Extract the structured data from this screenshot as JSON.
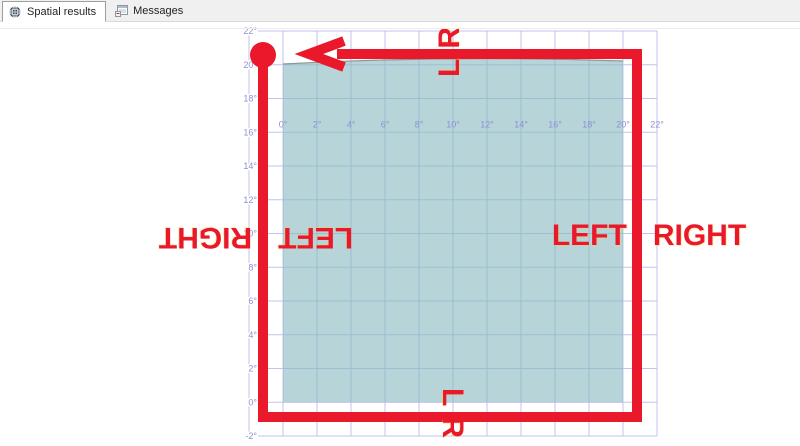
{
  "tabs": {
    "items": [
      {
        "label": "Spatial results",
        "icon": "globe-icon",
        "active": true
      },
      {
        "label": "Messages",
        "icon": "messages-icon",
        "active": false
      }
    ]
  },
  "spatial_view": {
    "grid": {
      "left": 249,
      "top": 31,
      "col_width": 34,
      "row_height": 33.75,
      "cols": 12,
      "rows": 12,
      "line_color": "#c2c2ec",
      "label_color": "#8f8fd2",
      "label_font_px": 9
    },
    "x_axis_labels": [
      "0°",
      "2°",
      "4°",
      "6°",
      "8°",
      "10°",
      "12°",
      "14°",
      "16°",
      "18°",
      "20°",
      "22°"
    ],
    "x_axis_label_row_y": 127.5,
    "y_axis_labels": [
      "22°",
      "20°",
      "18°",
      "16°",
      "14°",
      "12°",
      "10°",
      "8°",
      "6°",
      "4°",
      "2°",
      "0°",
      "-2°"
    ],
    "polygon": {
      "fill": "rgba(135,185,190,0.6)",
      "top_stroke": "#8d979c",
      "x_left": 283,
      "x_right": 623,
      "y_bottom": 402.25,
      "y_top_left": 64,
      "y_top_peak": 55,
      "y_top_right": 61
    }
  },
  "annotations": {
    "color": "#e9182b",
    "stroke_width": 10,
    "box": {
      "left": 263,
      "top": 54,
      "right": 637,
      "bottom": 417
    },
    "arrow": {
      "tip_x": 309,
      "tip_y": 54,
      "arm_x": 344,
      "arm_top_y": 41,
      "arm_bottom_y": 67
    },
    "circle": {
      "cx": 263,
      "cy": 55,
      "r": 13
    },
    "top_letters": {
      "first": "L",
      "second": "R"
    },
    "bottom_letters": {
      "first": "L",
      "second": "R"
    },
    "left_words": {
      "first": "LEFT",
      "second": "RIGHT"
    },
    "right_words": {
      "first": "LEFT",
      "second": "RIGHT"
    }
  }
}
